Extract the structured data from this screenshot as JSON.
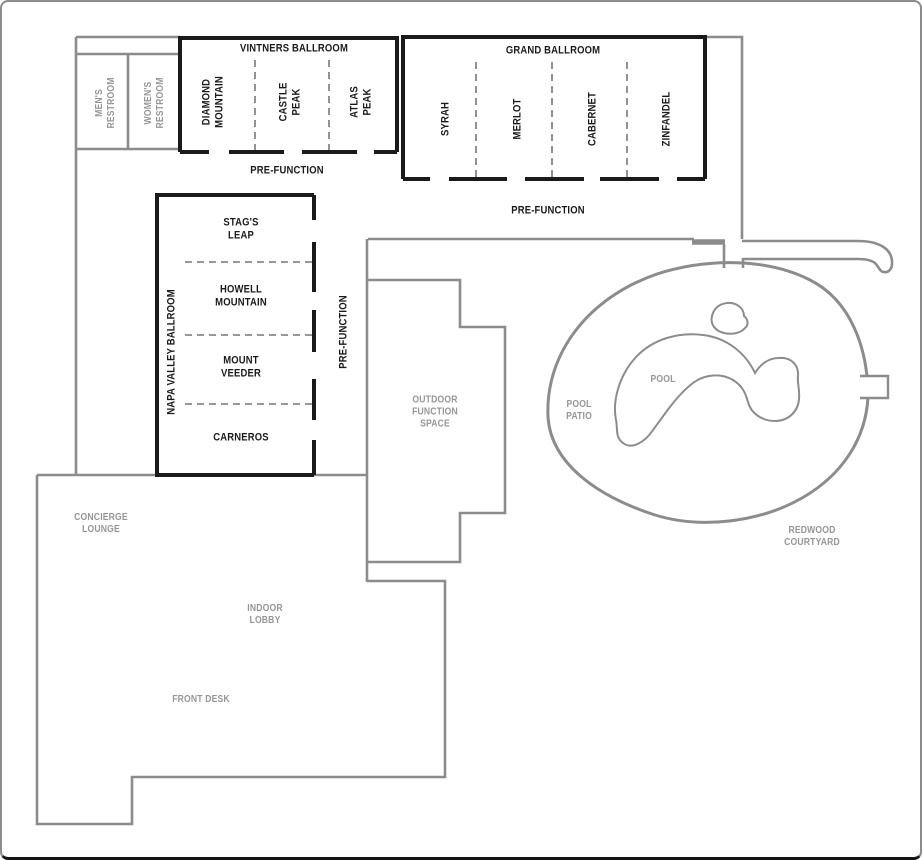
{
  "colors": {
    "wall_gray": "#8c8c8c",
    "wall_black": "#1a1a1a",
    "divider_gray": "#777777",
    "label_gray": "#969696",
    "label_black": "#1a1a1a",
    "background": "#ffffff"
  },
  "rooms": {
    "vintners": {
      "title": "VINTNERS BALLROOM",
      "room_1": "DIAMOND\nMOUNTAIN",
      "room_2": "CASTLE\nPEAK",
      "room_3": "ATLAS\nPEAK",
      "prefunction_label": "PRE-FUNCTION"
    },
    "grand": {
      "title": "GRAND BALLROOM",
      "room_1": "SYRAH",
      "room_2": "MERLOT",
      "room_3": "CABERNET",
      "room_4": "ZINFANDEL",
      "prefunction_label": "PRE-FUNCTION"
    },
    "napa": {
      "title": "NAPA VALLEY BALLROOM",
      "room_1": "STAG'S\nLEAP",
      "room_2": "HOWELL\nMOUNTAIN",
      "room_3": "MOUNT\nVEEDER",
      "room_4": "CARNEROS",
      "prefunction_label": "PRE-FUNCTION"
    },
    "restrooms": {
      "mens": "MEN'S\nRESTROOM",
      "womens": "WOMEN'S\nRESTROOM"
    },
    "outdoor": {
      "function_space": "OUTDOOR\nFUNCTION\nSPACE",
      "pool": "POOL",
      "pool_patio": "POOL\nPATIO",
      "redwood_courtyard": "REDWOOD\nCOURTYARD"
    },
    "lobby": {
      "concierge_lounge": "CONCIERGE\nLOUNGE",
      "indoor_lobby": "INDOOR\nLOBBY",
      "front_desk": "FRONT DESK"
    }
  }
}
